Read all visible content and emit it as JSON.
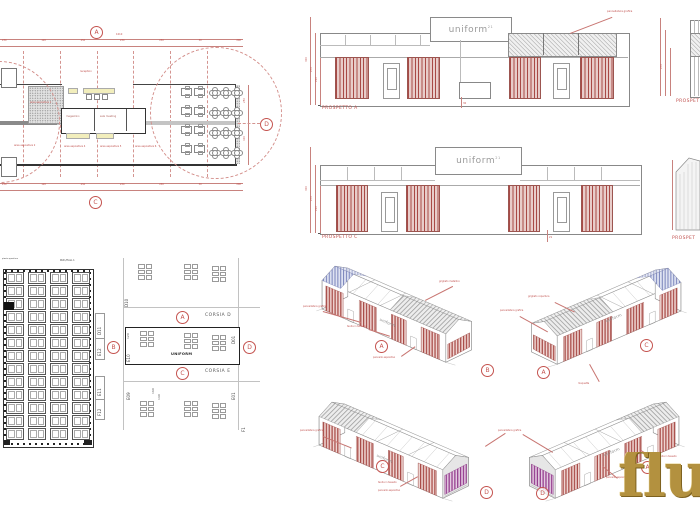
{
  "colors": {
    "accent": "#c0504d",
    "stripe_red": "#a84a46",
    "stripe_magenta": "#93398c",
    "stripe_blue": "#7d87bd",
    "gold": "#b3913f"
  },
  "floor_plan": {
    "markers": {
      "top": "A",
      "bottom": "C",
      "right": "D"
    },
    "dim_total": "1010",
    "dims_top": [
      "230",
      "120",
      "250",
      "230",
      "250",
      "30",
      "200"
    ],
    "dims_bottom": [
      "230",
      "120",
      "250",
      "230",
      "250",
      "30",
      "200"
    ],
    "dims_right": [
      "250",
      "400"
    ],
    "labels": {
      "reception": "reception",
      "a1": "area espositiva 1",
      "a2": "area espositiva 2",
      "a4": "area espositiva 4",
      "a5": "area espositiva 5",
      "a6": "area espositiva 6",
      "storage": "magazzino",
      "meeting": "sala meeting"
    }
  },
  "elevations": {
    "a": {
      "label": "PROSPETTO A",
      "logo": "uniform",
      "logo_sup": "21",
      "note": "pannellatura grafica",
      "dims": [
        "300",
        "270",
        "210"
      ],
      "tick": "30"
    },
    "c": {
      "label": "PROSPETTO C",
      "logo": "uniform",
      "logo_sup": "21",
      "dims": [
        "300",
        "270",
        "210"
      ],
      "tick": "21"
    },
    "b_partial": {
      "label": "PROSPET",
      "dims": [
        "300",
        "270"
      ]
    },
    "d_partial": {
      "label": "PROSPET"
    }
  },
  "hall_plan": {
    "title": "PAD./HALL 1",
    "note": "pianta quartiere"
  },
  "booth_plan": {
    "corsia_d": "CORSIA D",
    "corsia_e": "CORSIA E",
    "uniform": "UNIFORM",
    "markers": {
      "a": "A",
      "b": "B",
      "c": "C",
      "d": "D"
    },
    "booths": {
      "d10": "D10",
      "d11": "D11",
      "e12": "E12",
      "e10": "E10",
      "e09": "E09",
      "e11": "E11",
      "f12": "F12",
      "d01": "D01",
      "e01": "E01",
      "f1": "F1"
    },
    "dims": {
      "w": "120",
      "l1": "160",
      "l2": "140"
    }
  },
  "axons": [
    {
      "letters": [
        "A",
        "B"
      ],
      "logo": "uniform",
      "notes": [
        "pannellatura grafica",
        "tenda in tessuto",
        "grigliato metallico",
        "pannello espositivo"
      ]
    },
    {
      "letters": [
        "A",
        "C"
      ],
      "logo": "uniform",
      "notes": [
        "grigliato copertura",
        "pannellatura grafica",
        "moquette"
      ]
    },
    {
      "letters": [
        "C",
        "D"
      ],
      "logo": "uniform",
      "notes": [
        "pannellatura grafica",
        "tenda in tessuto",
        "pannello espositivo"
      ]
    },
    {
      "letters": [
        "D",
        "A"
      ],
      "logo": "uniform",
      "notes": [
        "pannellatura grafica",
        "pannello espositivo",
        "tenda in tessuto"
      ]
    }
  ],
  "watermark": "flu"
}
